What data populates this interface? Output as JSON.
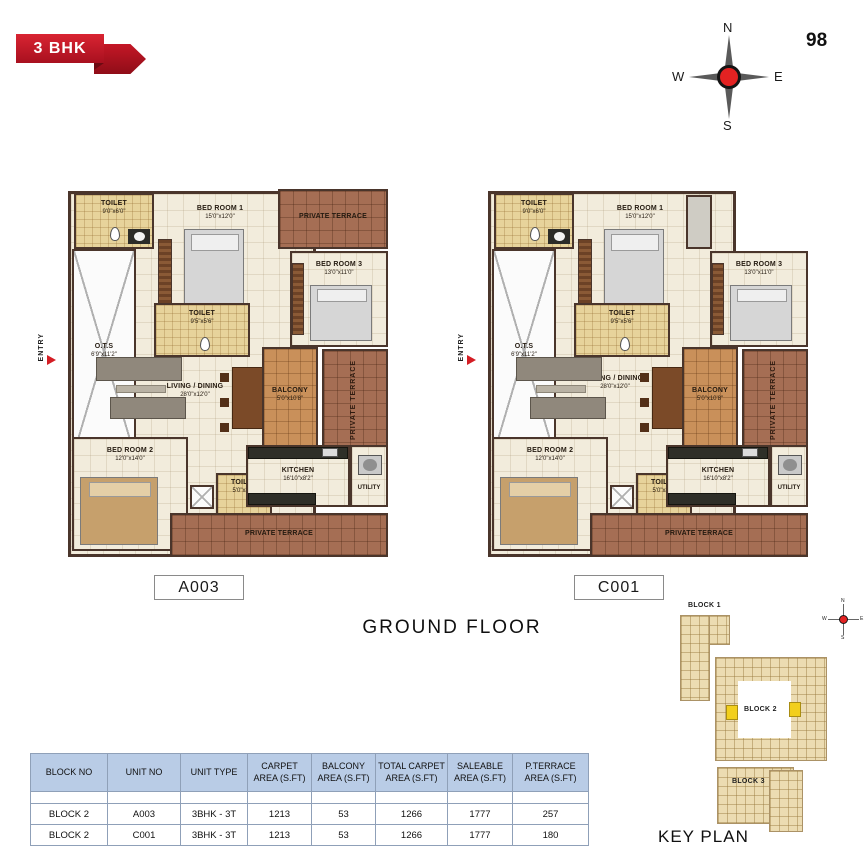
{
  "badge": {
    "label": "3 BHK"
  },
  "page_number": "98",
  "floor_title": "GROUND FLOOR",
  "compass": {
    "n": "N",
    "e": "E",
    "s": "S",
    "w": "W"
  },
  "rooms": {
    "toilet1": {
      "name": "TOILET",
      "dims": "9'0\"x6'0\""
    },
    "bedroom1": {
      "name": "BED ROOM 1",
      "dims": "15'0\"x12'0\""
    },
    "terrace": {
      "name": "PRIVATE TERRACE"
    },
    "bedroom3": {
      "name": "BED ROOM 3",
      "dims": "13'0\"x11'0\""
    },
    "ots": {
      "name": "O.T.S",
      "dims": "6'9\"x11'2\""
    },
    "toilet2": {
      "name": "TOILET",
      "dims": "9'5\"x5'6\""
    },
    "living": {
      "name": "LIVING / DINING",
      "dims": "28'0\"x12'0\""
    },
    "balcony": {
      "name": "BALCONY",
      "dims": "5'0\"x10'8\""
    },
    "bedroom2": {
      "name": "BED ROOM 2",
      "dims": "12'0\"x14'0\""
    },
    "toilet3": {
      "name": "TOILET",
      "dims": "5'0\"x8'6\""
    },
    "kitchen": {
      "name": "KITCHEN",
      "dims": "16'10\"x8'2\""
    },
    "utility": {
      "name": "UTILITY"
    },
    "entry": {
      "name": "ENTRY"
    }
  },
  "plans": [
    {
      "unit": "A003"
    },
    {
      "unit": "C001"
    }
  ],
  "key_plan": {
    "title": "KEY PLAN",
    "blocks": [
      "BLOCK 1",
      "BLOCK 2",
      "BLOCK 3"
    ]
  },
  "area_table": {
    "headers": [
      "BLOCK NO",
      "UNIT NO",
      "UNIT TYPE",
      "CARPET AREA (S.FT)",
      "BALCONY AREA (S.FT)",
      "TOTAL CARPET AREA (S.FT)",
      "SALEABLE AREA (S.FT)",
      "P.TERRACE AREA (S.FT)"
    ],
    "rows": [
      [
        "BLOCK 2",
        "A003",
        "3BHK - 3T",
        "1213",
        "53",
        "1266",
        "1777",
        "257"
      ],
      [
        "BLOCK 2",
        "C001",
        "3BHK - 3T",
        "1213",
        "53",
        "1266",
        "1777",
        "180"
      ]
    ]
  }
}
